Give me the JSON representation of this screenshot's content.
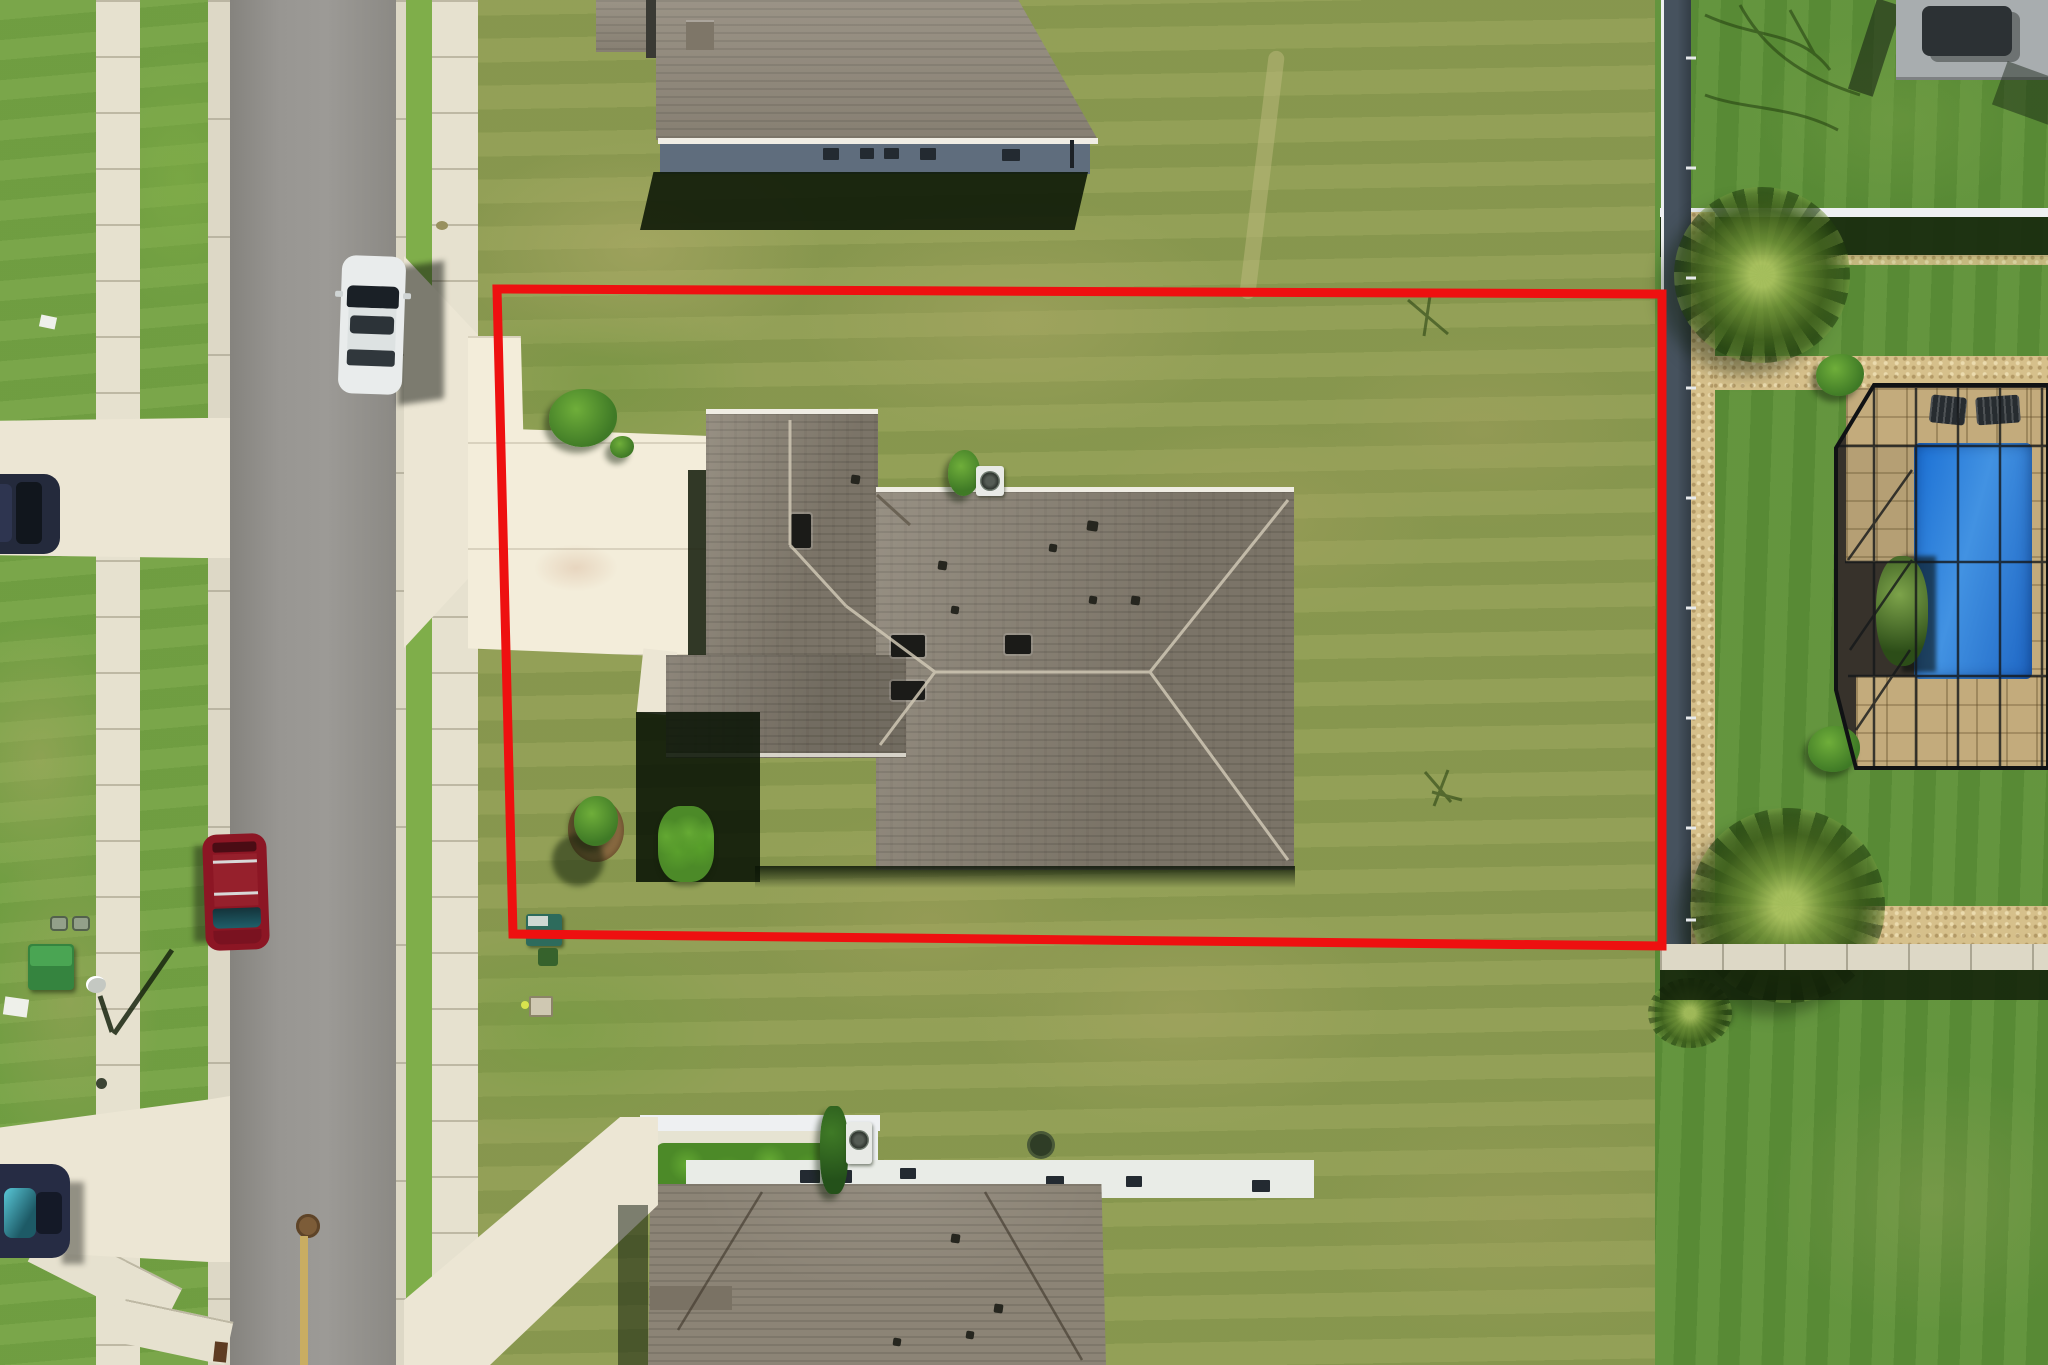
{
  "scene": {
    "type": "aerial-drone-photo",
    "description": "Overhead aerial photo of a suburban single-family home lot outlined with a red property boundary, with a street and parked cars on the left, neighboring houses above and below, and a neighboring screened pool enclosure with palm trees on the right.",
    "boundary_shape": "rectangle",
    "visible_text": ""
  },
  "objects": {
    "property_boundary": "Red property boundary outline",
    "subject_house": "Subject house with gray shingle hip roof",
    "subject_driveway": "Concrete driveway of subject house",
    "top_house": "Neighboring house at top",
    "bottom_house": "Neighboring house at bottom",
    "road": "Asphalt residential street",
    "east_sidewalk": "Sidewalk east of street",
    "west_sidewalk": "Sidewalk west of street",
    "white_car": "White car parked on street",
    "red_car": "Maroon car parked on street",
    "navy_car_top": "Dark car in west driveway",
    "navy_car_bottom": "Dark car in west driveway (lower)",
    "pool_enclosure": "Screened pool enclosure on right neighbor lot",
    "pool": "Blue swimming pool",
    "pavilion": "Covered patio structure at top right",
    "fence": "Dark fence along right boundary",
    "palm_tree_upper": "Palm tree upper right",
    "palm_tree_lower": "Palm tree lower right",
    "streetlight": "Streetlight head and shadow",
    "utility_boxes": "Utility boxes near lot corner",
    "ac_unit": "Air-conditioner condenser unit",
    "hedge": "Trimmed hedge of bottom house patio"
  },
  "palette": {
    "red_line": "#ee1010",
    "grass_lot": "#8e9c52",
    "grass_front": "#74a244",
    "grass_right": "#5d9038",
    "grass_blvd": "#7fae4a",
    "road": "#918f8b",
    "curb": "#ddd8c6",
    "sidewalk": "#e6e1cf",
    "driveway": "#ece6d4",
    "driveway_bright": "#f3edda",
    "roof_main": "#8c8476",
    "roof_light": "#928a7c",
    "roof_dark": "#7a7264",
    "ridge_cap": "#cfc7b4",
    "fascia": "#f0ede4",
    "wall_shade": "#5f6d7d",
    "shadow_dark": "#101b0c",
    "pool_blue": "#1a6fd4",
    "pool_blue_light": "#4292e2",
    "paver_tan": "#c3ab7c",
    "pebble_dark": "#37322b",
    "gravel": "#d6c08b",
    "fence_dark": "#333d46",
    "fence_white": "#eef0f2",
    "hedge_green": "#4c8a28",
    "bush_green": "#3f7a26",
    "bush_light": "#6fae3a",
    "ac_white": "#e8eae6",
    "utility_teal": "#2d6b5c",
    "utility_green": "#35843f",
    "car_white": "#e9ecec",
    "car_red": "#8c1624",
    "car_navy": "#242a3c",
    "glass_dark": "#1a2026",
    "glass_cyan": "#59c8d8",
    "mulch": "#8a6b42",
    "lamp_gray": "#c4c8c2",
    "pole_tan": "#c9ad62",
    "stake_brown": "#5e3c22"
  }
}
